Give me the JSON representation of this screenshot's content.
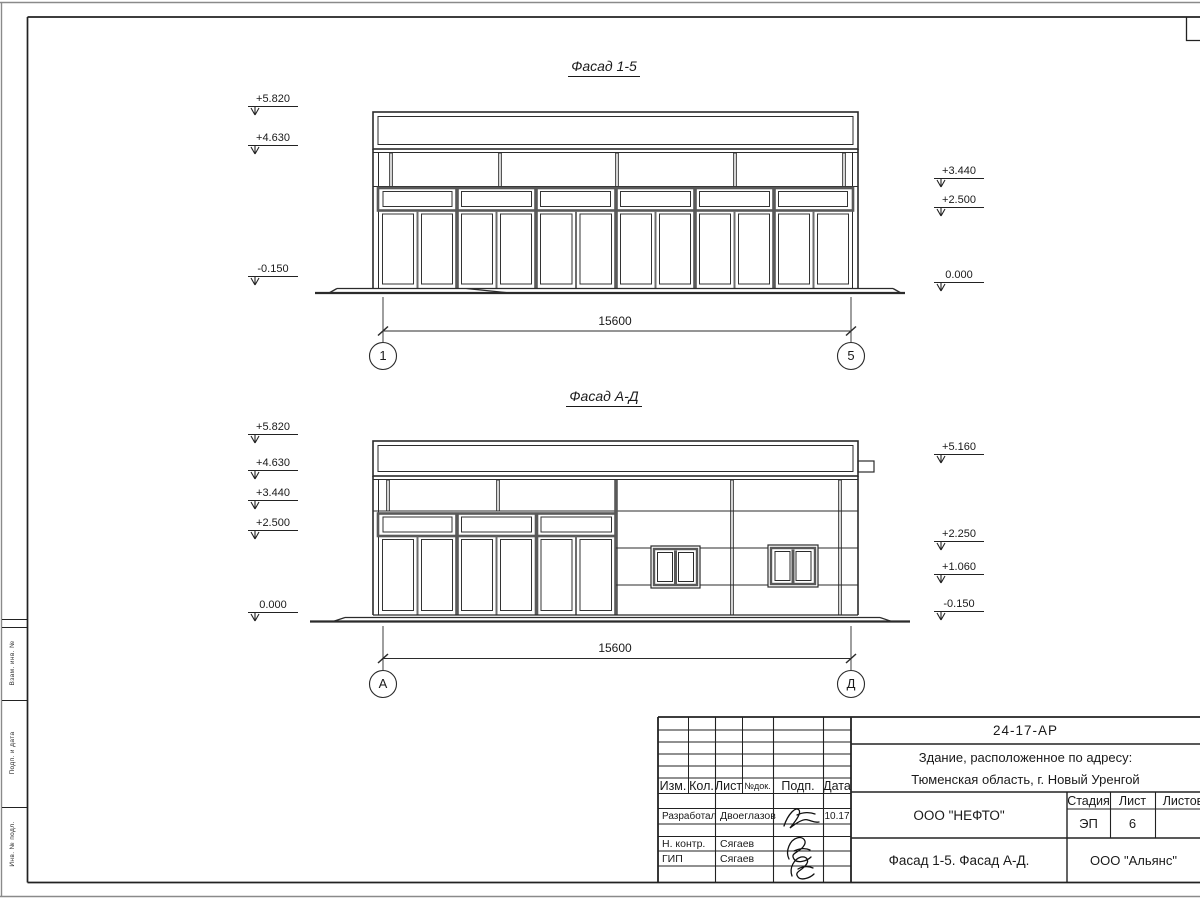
{
  "facades": {
    "f15": {
      "title": "Фасад 1-5",
      "marks_left": [
        "+5.820",
        "+4.630",
        "-0.150"
      ],
      "marks_right": [
        "+3.440",
        "+2.500",
        "0.000"
      ],
      "dimension": "15600",
      "axis_left": "1",
      "axis_right": "5"
    },
    "fad": {
      "title": "Фасад А-Д",
      "marks_left": [
        "+5.820",
        "+4.630",
        "+3.440",
        "+2.500",
        "0.000"
      ],
      "marks_right": [
        "+5.160",
        "+2.250",
        "+1.060",
        "-0.150"
      ],
      "dimension": "15600",
      "axis_left": "А",
      "axis_right": "Д"
    }
  },
  "titleblock": {
    "doc_number": "24-17-АР",
    "object_line1": "Здание, расположенное по адресу:",
    "object_line2": "Тюменская область, г. Новый Уренгой",
    "columns": [
      "Изм.",
      "Кол.",
      "Лист",
      "№док.",
      "Подп.",
      "Дата"
    ],
    "rows": [
      {
        "role": "Разработал",
        "name": "Двоеглазов",
        "date": "10.17"
      },
      {
        "role": "Н. контр.",
        "name": "Сягаев",
        "date": ""
      },
      {
        "role": "ГИП",
        "name": "Сягаев",
        "date": ""
      }
    ],
    "org": "ООО \"НЕФТО\"",
    "stage_label": "Стадия",
    "list_label": "Лист",
    "listov_label": "Листов",
    "stage": "ЭП",
    "list_num": "6",
    "doc_title": "Фасад 1-5. Фасад А-Д.",
    "org2": "ООО \"Альянс\""
  },
  "margin_stamps": [
    "Взам. инв. №",
    "Подп. и дата",
    "Инв. № подл."
  ]
}
